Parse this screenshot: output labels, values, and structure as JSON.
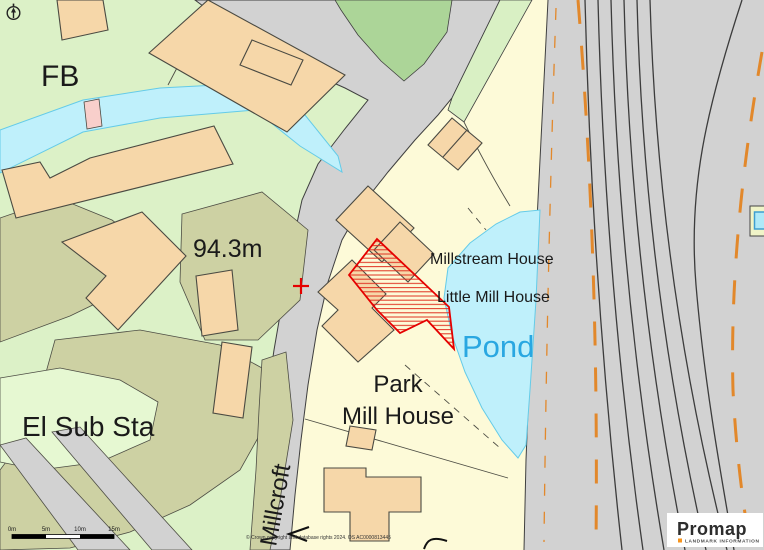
{
  "window": {
    "width": 764,
    "height": 550
  },
  "map": {
    "kind": "os-large-scale-plan",
    "labels": {
      "fb": "FB",
      "spot_height": "94.3m",
      "el_sub_sta": "El Sub Sta",
      "millstream_house": "Millstream House",
      "little_mill_house": "Little Mill House",
      "pond": "Pond",
      "park": "Park",
      "mill_house": "Mill House",
      "millcroft": "Millcroft"
    },
    "colors": {
      "plot_cream": "#FDFAD8",
      "grass_green": "#DCF1C7",
      "wood_green": "#ACD598",
      "scrub_olive": "#CDD1A3",
      "building_tan": "#F6D7A9",
      "road_gray": "#D2D2D2",
      "water_cyan": "#BFF0FB",
      "boundary_orange": "#E2882B",
      "selection_red": "#E50000",
      "pond_label_blue": "#29A7E1",
      "footbridge_pink": "#F8CFCB"
    }
  },
  "scale_bar": {
    "ticks": [
      "0m",
      "5m",
      "10m",
      "15m"
    ]
  },
  "attribution": "© Crown copyright and database rights 2024. OS AC0000813445",
  "logo": {
    "name": "Promap",
    "tagline": "LANDMARK INFORMATION",
    "bullet_color": "#F7941D"
  }
}
